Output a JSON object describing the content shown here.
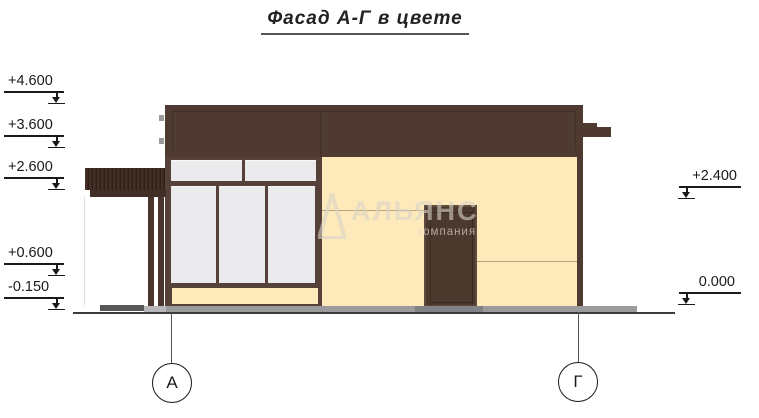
{
  "title": {
    "text": "Фасад А-Г в цвете"
  },
  "levels": {
    "left": [
      {
        "label": "+4.600"
      },
      {
        "label": "+3.600"
      },
      {
        "label": "+2.600"
      },
      {
        "label": "+0.600"
      },
      {
        "label": "-0.150"
      }
    ],
    "right": [
      {
        "label": "+2.400"
      },
      {
        "label": "0.000"
      }
    ]
  },
  "axes": {
    "left": {
      "label": "А"
    },
    "right": {
      "label": "Г"
    }
  },
  "watermark": {
    "name": "АЛЬЯНС",
    "subtitle": "компания"
  },
  "colors": {
    "roof_brown": "#4E3A31",
    "frame_brown": "#55413A",
    "wall_cream": "#FDE9BA",
    "glass_gray": "#EBEBED",
    "door_brown": "#4C392E",
    "canopy_brown": "#45322A",
    "plinth_gray": "#9B9B9D"
  }
}
